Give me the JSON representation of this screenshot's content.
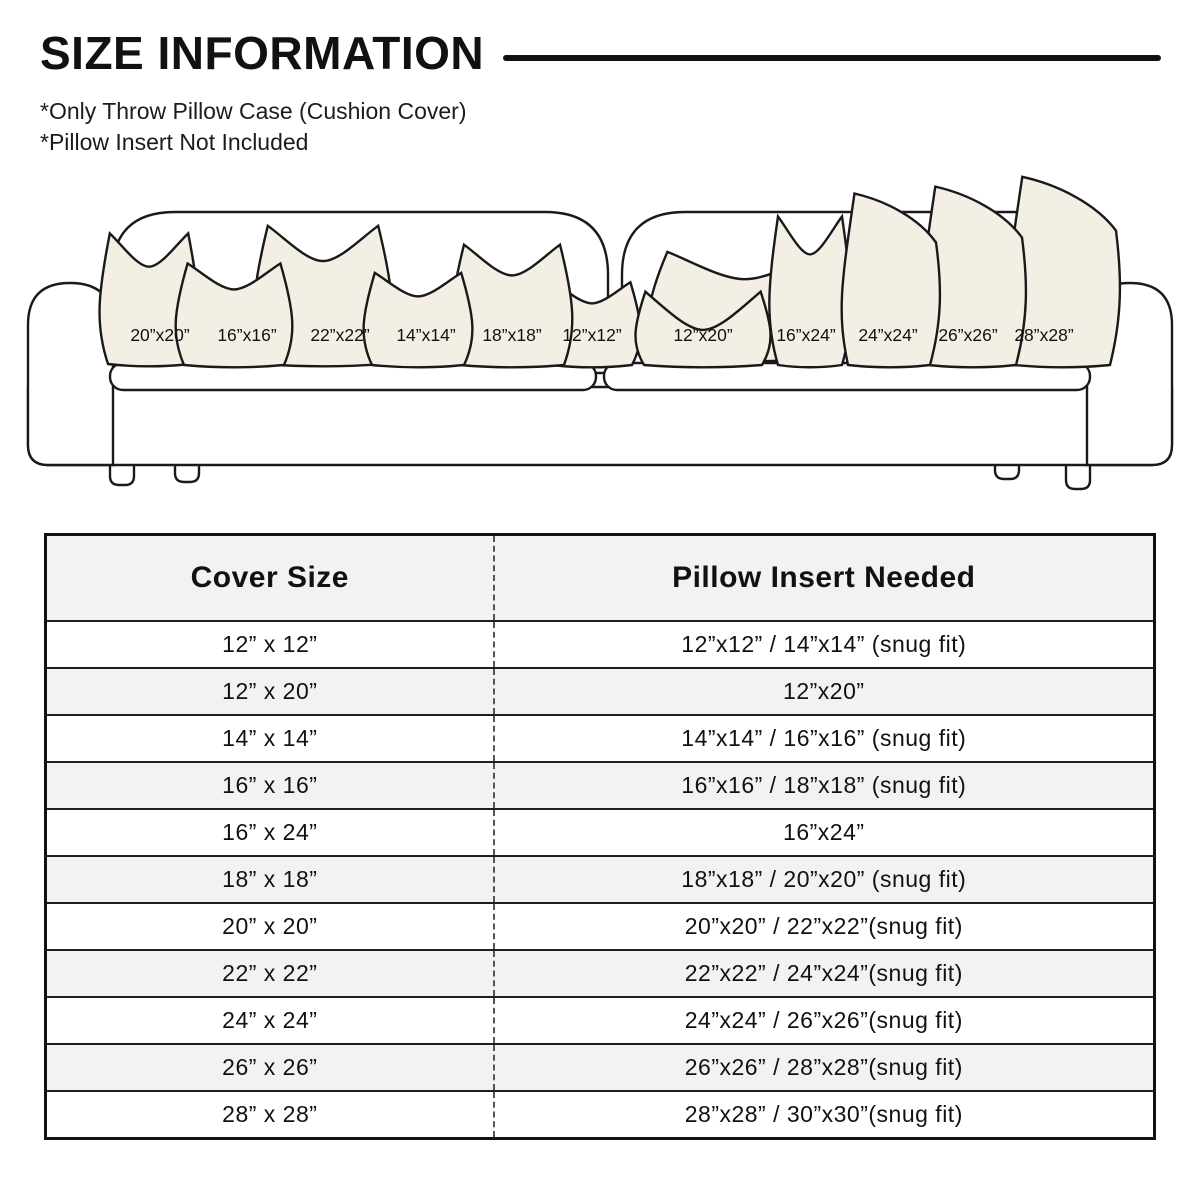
{
  "header": {
    "title": "SIZE INFORMATION",
    "notes": [
      "*Only Throw Pillow Case (Cushion Cover)",
      "*Pillow Insert Not Included"
    ]
  },
  "sofa": {
    "colors": {
      "pillow_fill": "#f3efe4",
      "outline": "#1a1a1a"
    },
    "pillows": [
      {
        "label": "20”x20”"
      },
      {
        "label": "16”x16”"
      },
      {
        "label": "22”x22”"
      },
      {
        "label": "14”x14”"
      },
      {
        "label": "18”x18”"
      },
      {
        "label": "12”x12”"
      },
      {
        "label": "12”x20”"
      },
      {
        "label": "16”x24”"
      },
      {
        "label": "24”x24”"
      },
      {
        "label": "26”x26”"
      },
      {
        "label": "28”x28”"
      }
    ]
  },
  "table": {
    "headers": [
      "Cover Size",
      "Pillow Insert Needed"
    ],
    "stripe_color": "#f2f2f2",
    "rows": [
      [
        "12” x 12”",
        "12”x12” / 14”x14” (snug fit)"
      ],
      [
        "12” x 20”",
        "12”x20”"
      ],
      [
        "14” x 14”",
        "14”x14” / 16”x16” (snug fit)"
      ],
      [
        "16” x 16”",
        "16”x16” / 18”x18” (snug fit)"
      ],
      [
        "16” x 24”",
        "16”x24”"
      ],
      [
        "18” x 18”",
        "18”x18” / 20”x20” (snug fit)"
      ],
      [
        "20” x 20”",
        "20”x20” / 22”x22”(snug fit)"
      ],
      [
        "22” x 22”",
        "22”x22” / 24”x24”(snug fit)"
      ],
      [
        "24” x 24”",
        "24”x24” / 26”x26”(snug fit)"
      ],
      [
        "26” x 26”",
        "26”x26” / 28”x28”(snug fit)"
      ],
      [
        "28” x 28”",
        "28”x28” / 30”x30”(snug fit)"
      ]
    ]
  }
}
